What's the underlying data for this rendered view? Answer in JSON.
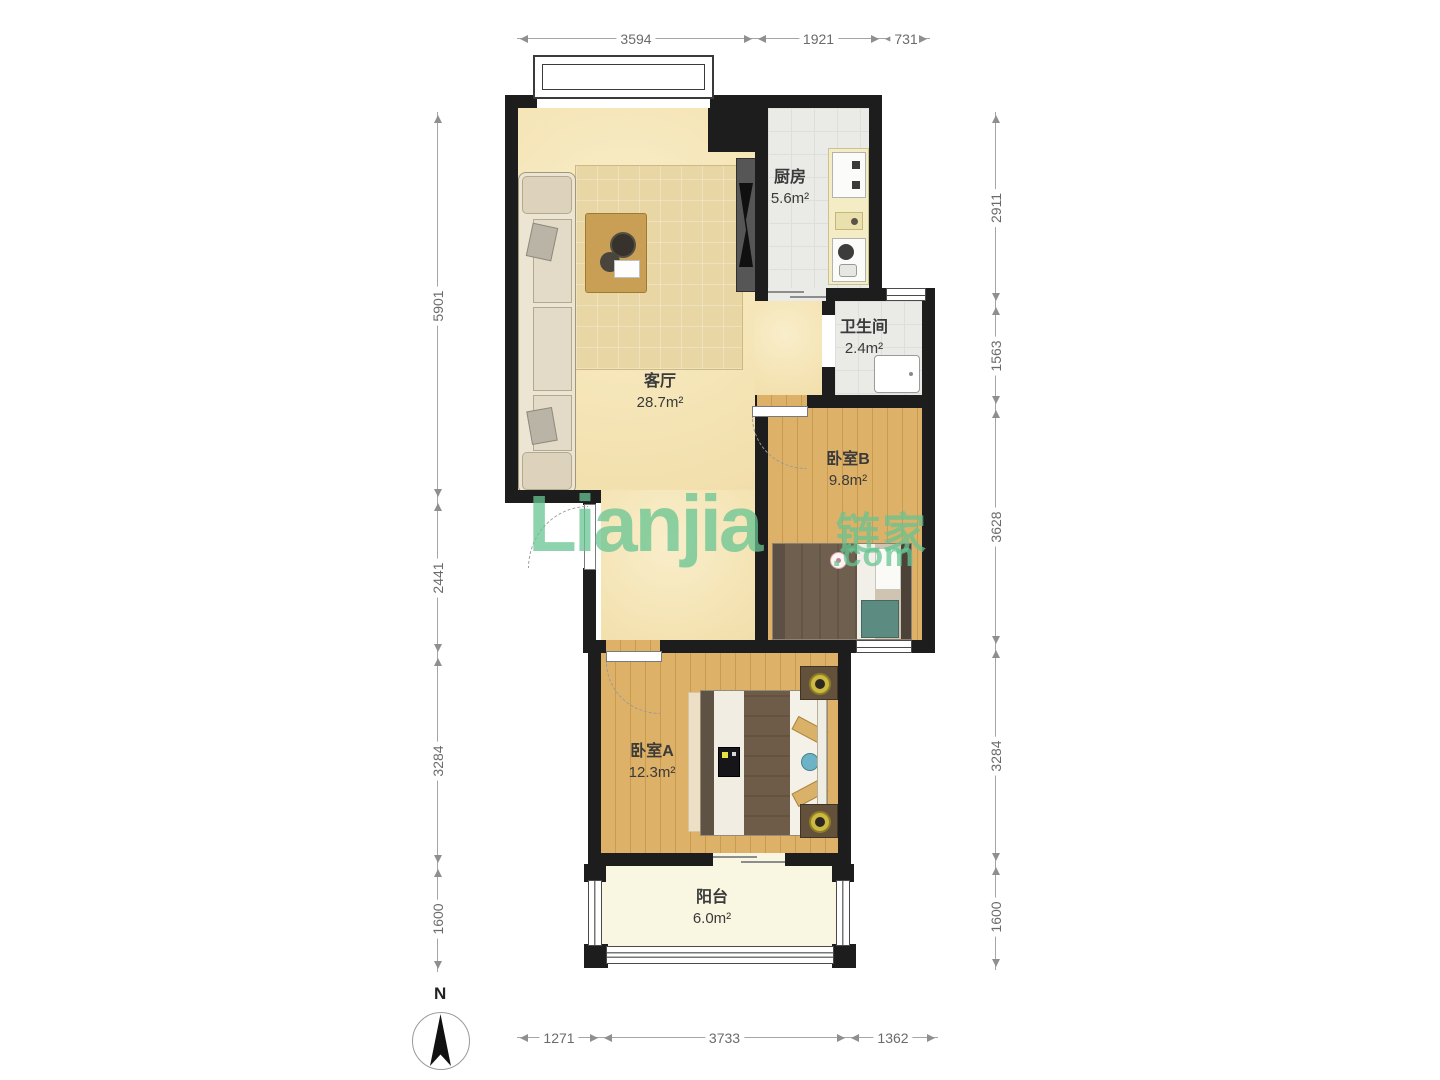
{
  "watermark": {
    "logo": "Lianjia",
    "cn": "链家",
    "com": ".com"
  },
  "compass": {
    "label": "N"
  },
  "rooms": [
    {
      "name": "客厅",
      "area": "28.7m²"
    },
    {
      "name": "厨房",
      "area": "5.6m²"
    },
    {
      "name": "卫生间",
      "area": "2.4m²"
    },
    {
      "name": "卧室B",
      "area": "9.8m²"
    },
    {
      "name": "卧室A",
      "area": "12.3m²"
    },
    {
      "name": "阳台",
      "area": "6.0m²"
    }
  ],
  "dimensions": {
    "top": [
      "3594",
      "1921",
      "731"
    ],
    "bottom": [
      "1271",
      "3733",
      "1362"
    ],
    "left": [
      "5901",
      "2441",
      "3284",
      "1600"
    ],
    "right": [
      "2911",
      "1563",
      "3628",
      "3284",
      "1600"
    ]
  },
  "colors": {
    "wall": "#1d1d1d",
    "living_floor": "#f6e7bb",
    "wood_floor": "#ddb163",
    "tile_floor": "#eaeae7",
    "balcony_floor": "#f9f6e2",
    "watermark_green": "#67c492",
    "dim_text": "#6a6a6a"
  }
}
